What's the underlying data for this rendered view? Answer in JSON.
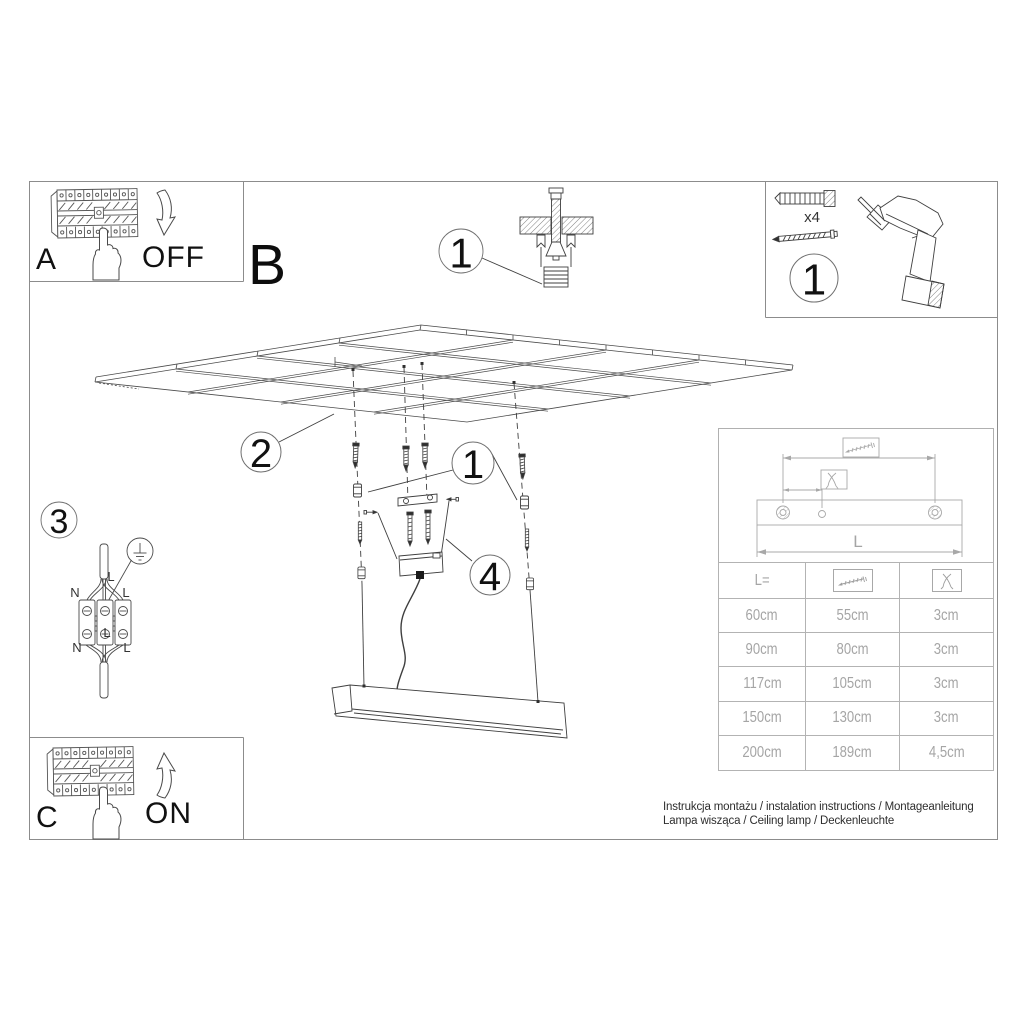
{
  "page": {
    "instructions_line1": "Instrukcja montażu / instalation instructions / Montageanleitung",
    "instructions_line2": "Lampa wisząca / Ceiling lamp / Deckenleuchte"
  },
  "steps": {
    "a": {
      "label": "A",
      "action": "OFF"
    },
    "b": {
      "label": "B"
    },
    "c": {
      "label": "C",
      "action": "ON"
    }
  },
  "callouts": {
    "anchor_detail": "1",
    "hardware_kit": "1",
    "suspended_ceiling": "2",
    "anchors": "1",
    "wiring": "3",
    "canopy": "4"
  },
  "hardware": {
    "dowel_quantity": "x4"
  },
  "wiring": {
    "top_left": "N",
    "top_right": "L",
    "bottom_left": "N",
    "bottom_right": "L",
    "cable_label": "L",
    "center_label": "L"
  },
  "size_table": {
    "length_header": "L=",
    "dimension_label": "L",
    "rows": [
      [
        "60cm",
        "55cm",
        "3cm"
      ],
      [
        "90cm",
        "80cm",
        "3cm"
      ],
      [
        "117cm",
        "105cm",
        "3cm"
      ],
      [
        "150cm",
        "130cm",
        "3cm"
      ],
      [
        "200cm",
        "189cm",
        "4,5cm"
      ]
    ]
  },
  "icons": {
    "screw": "screw-icon",
    "pliers": "pliers-icon",
    "drill": "drill-icon",
    "wall_plug": "wall-plug-icon",
    "hand": "hand-press-icon",
    "arrow_off": "arrow-down-icon",
    "arrow_on": "arrow-up-icon",
    "ground": "ground-symbol-icon"
  },
  "colors": {
    "line": "#404040",
    "panel_border": "#8c8c8c",
    "table_gray": "#a8a8a8",
    "text": "#1c1c1c"
  }
}
